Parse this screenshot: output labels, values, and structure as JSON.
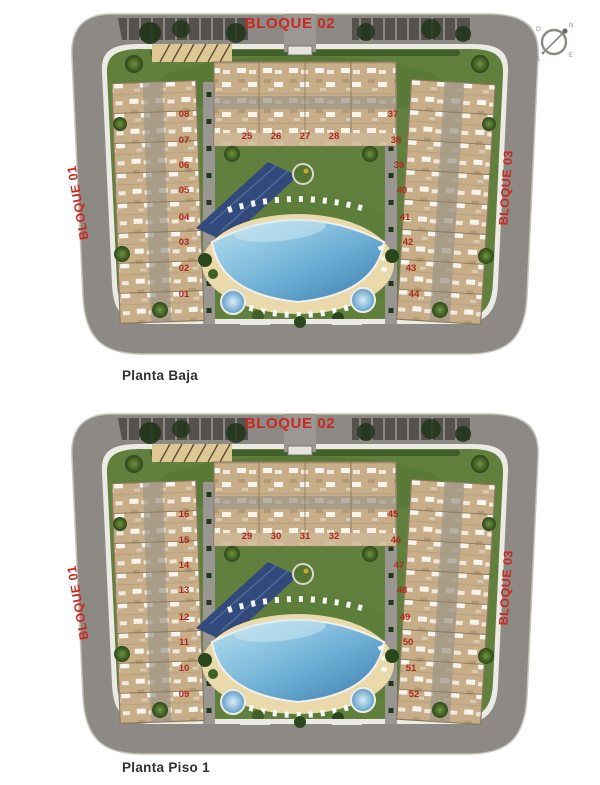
{
  "document": {
    "type": "residential development site plans",
    "captions": {
      "plan1": "Planta Baja",
      "plan2": "Planta Piso 1"
    }
  },
  "colors": {
    "label_red": "#cb2920",
    "unit_red": "#b0271d",
    "road_gray": "#8d8985",
    "curb_white": "#eceae5",
    "lawn_green": "#61803d",
    "building_tan": "#c7ae89",
    "pool_blue": "#5b9cc8",
    "sand": "#ead9ab",
    "shade_blue": "#324a7b"
  },
  "compass": {
    "letters": {
      "n": "N",
      "o": "O",
      "e": "E",
      "s": "S"
    }
  },
  "plans": [
    {
      "caption": "Planta Baja",
      "block_top": {
        "label": "BLOQUE 02",
        "units": [
          "25",
          "26",
          "27",
          "28"
        ]
      },
      "block_left": {
        "label": "BLOQUE 01",
        "units": [
          "08",
          "07",
          "06",
          "05",
          "04",
          "03",
          "02",
          "01"
        ]
      },
      "block_right": {
        "label": "BLOQUE 03",
        "units": [
          "37",
          "38",
          "39",
          "40",
          "41",
          "42",
          "43",
          "44"
        ]
      }
    },
    {
      "caption": "Planta Piso 1",
      "block_top": {
        "label": "BLOQUE 02",
        "units": [
          "29",
          "30",
          "31",
          "32"
        ]
      },
      "block_left": {
        "label": "BLOQUE 01",
        "units": [
          "16",
          "15",
          "14",
          "13",
          "12",
          "11",
          "10",
          "09"
        ]
      },
      "block_right": {
        "label": "BLOQUE 03",
        "units": [
          "45",
          "46",
          "47",
          "48",
          "49",
          "50",
          "51",
          "52"
        ]
      }
    }
  ]
}
